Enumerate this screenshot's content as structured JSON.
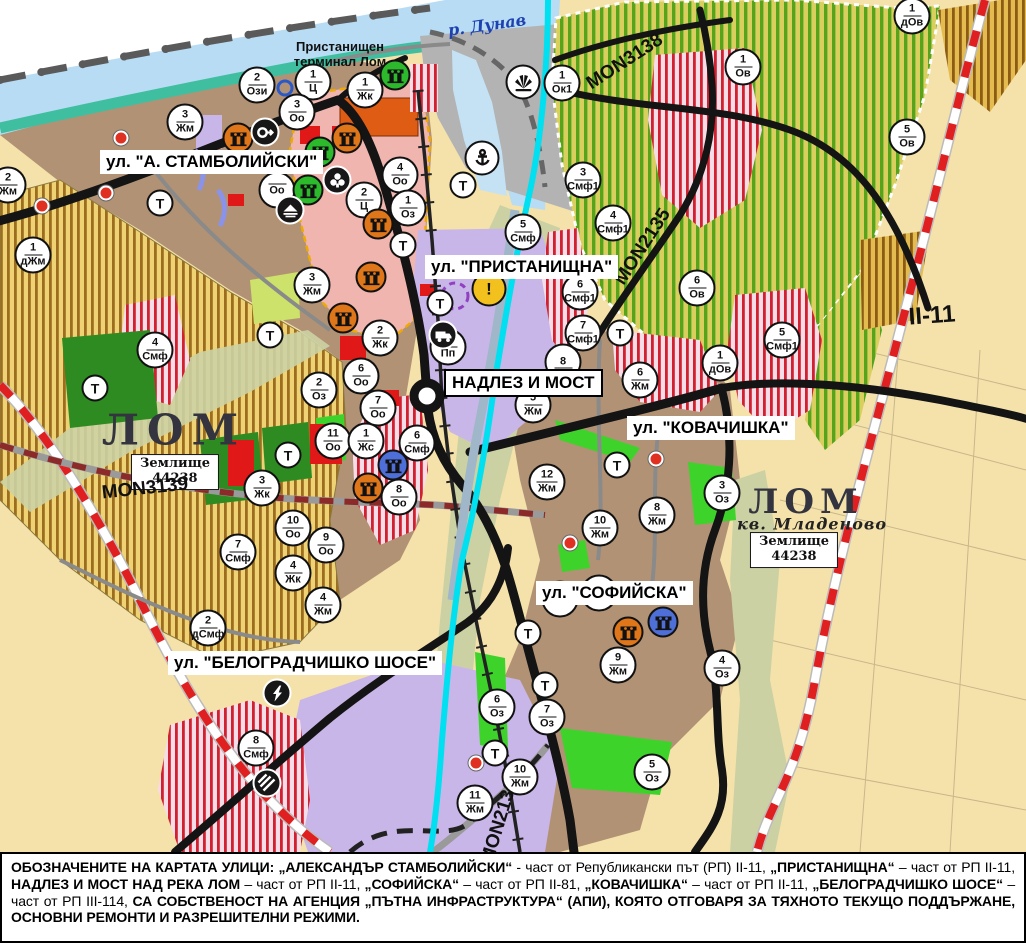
{
  "map": {
    "river_label": {
      "text": "р. Дунав",
      "x": 487,
      "y": 25,
      "fs": 16,
      "rot": -8
    },
    "terminal_label": {
      "line1": "Пристанищен",
      "line2": "терминал Лом",
      "x": 340,
      "y": 55,
      "fs": 13
    },
    "street_labels": [
      {
        "text": "ул. \"А. СТАМБОЛИЙСКИ\"",
        "x": 100,
        "y": 150,
        "fs": 17,
        "boxed": false
      },
      {
        "text": "ул. \"ПРИСТАНИЩНА\"",
        "x": 425,
        "y": 255,
        "fs": 17,
        "boxed": false
      },
      {
        "text": "НАДЛЕЗ И МОСТ",
        "x": 444,
        "y": 369,
        "fs": 17,
        "boxed": true
      },
      {
        "text": "ул. \"КОВАЧИШКА\"",
        "x": 627,
        "y": 416,
        "fs": 17,
        "boxed": false
      },
      {
        "text": "ул. \"СОФИЙСКА\"",
        "x": 536,
        "y": 581,
        "fs": 17,
        "boxed": false
      },
      {
        "text": "ул. \"БЕЛОГРАДЧИШКО ШОСЕ\"",
        "x": 168,
        "y": 651,
        "fs": 17,
        "boxed": false
      }
    ],
    "area_labels": [
      {
        "text": "ЛОМ",
        "x": 174,
        "y": 430,
        "fs": 42,
        "cls": "lom",
        "ls": 8
      },
      {
        "text": "ЛОМ",
        "x": 806,
        "y": 502,
        "fs": 34,
        "cls": "lom",
        "ls": 6
      },
      {
        "text": "кв. Младеново",
        "x": 812,
        "y": 524,
        "fs": 16,
        "cls": "mlad",
        "ls": 1
      }
    ],
    "zemlishte_boxes": [
      {
        "line1": "Землище",
        "line2": "44238",
        "x": 175,
        "y": 472
      },
      {
        "line1": "Землище",
        "line2": "44238",
        "x": 794,
        "y": 550
      }
    ],
    "road_labels": [
      {
        "text": "MON3139",
        "x": 145,
        "y": 489,
        "fs": 19,
        "rot": -6
      },
      {
        "text": "MON3138",
        "x": 625,
        "y": 62,
        "fs": 19,
        "rot": -33
      },
      {
        "text": "MON2135",
        "x": 643,
        "y": 247,
        "fs": 19,
        "rot": -57
      },
      {
        "text": "MON2136",
        "x": 500,
        "y": 822,
        "fs": 19,
        "rot": -73
      },
      {
        "text": "II-11",
        "x": 932,
        "y": 316,
        "fs": 24,
        "rot": -4
      }
    ],
    "t_label": "Т",
    "warn_label": "!",
    "zone_badges": [
      {
        "x": 257,
        "y": 85,
        "n": "2",
        "c": "Ози"
      },
      {
        "x": 313,
        "y": 82,
        "n": "1",
        "c": "Ц"
      },
      {
        "x": 365,
        "y": 90,
        "n": "1",
        "c": "Жк"
      },
      {
        "x": 297,
        "y": 112,
        "n": "3",
        "c": "Оо"
      },
      {
        "x": 185,
        "y": 122,
        "n": "3",
        "c": "Жм"
      },
      {
        "x": 8,
        "y": 185,
        "n": "2",
        "c": "Жм"
      },
      {
        "x": 33,
        "y": 255,
        "n": "1",
        "c": "дЖм"
      },
      {
        "x": 400,
        "y": 175,
        "n": "4",
        "c": "Оо"
      },
      {
        "x": 364,
        "y": 200,
        "n": "2",
        "c": "Ц"
      },
      {
        "x": 408,
        "y": 208,
        "n": "1",
        "c": "Оз"
      },
      {
        "x": 277,
        "y": 190,
        "n": "",
        "c": "Оо"
      },
      {
        "x": 562,
        "y": 83,
        "n": "1",
        "c": "Ок1"
      },
      {
        "x": 583,
        "y": 180,
        "n": "3",
        "c": "Смф1"
      },
      {
        "x": 613,
        "y": 223,
        "n": "4",
        "c": "Смф1"
      },
      {
        "x": 523,
        "y": 232,
        "n": "5",
        "c": "Смф"
      },
      {
        "x": 580,
        "y": 292,
        "n": "6",
        "c": "Смф1"
      },
      {
        "x": 583,
        "y": 333,
        "n": "7",
        "c": "Смф1"
      },
      {
        "x": 743,
        "y": 67,
        "n": "1",
        "c": "Ов"
      },
      {
        "x": 912,
        "y": 16,
        "n": "1",
        "c": "дОв"
      },
      {
        "x": 907,
        "y": 137,
        "n": "5",
        "c": "Ов"
      },
      {
        "x": 697,
        "y": 288,
        "n": "6",
        "c": "Ов"
      },
      {
        "x": 782,
        "y": 340,
        "n": "5",
        "c": "Смф1"
      },
      {
        "x": 720,
        "y": 363,
        "n": "1",
        "c": "дОв"
      },
      {
        "x": 312,
        "y": 285,
        "n": "3",
        "c": "Жм"
      },
      {
        "x": 380,
        "y": 338,
        "n": "2",
        "c": "Жк"
      },
      {
        "x": 361,
        "y": 376,
        "n": "6",
        "c": "Оо"
      },
      {
        "x": 319,
        "y": 390,
        "n": "2",
        "c": "Оз"
      },
      {
        "x": 378,
        "y": 408,
        "n": "7",
        "c": "Оо"
      },
      {
        "x": 333,
        "y": 441,
        "n": "11",
        "c": "Оо"
      },
      {
        "x": 366,
        "y": 441,
        "n": "1",
        "c": "Жс"
      },
      {
        "x": 417,
        "y": 443,
        "n": "6",
        "c": "Смф"
      },
      {
        "x": 399,
        "y": 497,
        "n": "8",
        "c": "Оо"
      },
      {
        "x": 262,
        "y": 488,
        "n": "3",
        "c": "Жк"
      },
      {
        "x": 155,
        "y": 350,
        "n": "4",
        "c": "Смф"
      },
      {
        "x": 238,
        "y": 552,
        "n": "7",
        "c": "Смф"
      },
      {
        "x": 293,
        "y": 528,
        "n": "10",
        "c": "Оо"
      },
      {
        "x": 326,
        "y": 545,
        "n": "9",
        "c": "Оо"
      },
      {
        "x": 293,
        "y": 573,
        "n": "4",
        "c": "Жк"
      },
      {
        "x": 323,
        "y": 605,
        "n": "4",
        "c": "Жм"
      },
      {
        "x": 208,
        "y": 628,
        "n": "2",
        "c": "дСмф"
      },
      {
        "x": 256,
        "y": 748,
        "n": "8",
        "c": "Смф"
      },
      {
        "x": 448,
        "y": 347,
        "n": "2",
        "c": "Пп"
      },
      {
        "x": 533,
        "y": 405,
        "n": "5",
        "c": "Жм"
      },
      {
        "x": 563,
        "y": 362,
        "n": "8",
        "c": ""
      },
      {
        "x": 640,
        "y": 380,
        "n": "6",
        "c": "Жм"
      },
      {
        "x": 547,
        "y": 482,
        "n": "12",
        "c": "Жм"
      },
      {
        "x": 600,
        "y": 528,
        "n": "10",
        "c": "Жм"
      },
      {
        "x": 657,
        "y": 515,
        "n": "8",
        "c": "Жм"
      },
      {
        "x": 722,
        "y": 493,
        "n": "3",
        "c": "Оз"
      },
      {
        "x": 560,
        "y": 599,
        "n": "",
        "c": "Оз"
      },
      {
        "x": 599,
        "y": 593,
        "n": "",
        "c": "Оз"
      },
      {
        "x": 618,
        "y": 665,
        "n": "9",
        "c": "Жм"
      },
      {
        "x": 722,
        "y": 668,
        "n": "4",
        "c": "Оз"
      },
      {
        "x": 652,
        "y": 772,
        "n": "5",
        "c": "Оз"
      },
      {
        "x": 497,
        "y": 707,
        "n": "6",
        "c": "Оз"
      },
      {
        "x": 547,
        "y": 717,
        "n": "7",
        "c": "Оз"
      },
      {
        "x": 520,
        "y": 777,
        "n": "10",
        "c": "Жм"
      },
      {
        "x": 475,
        "y": 803,
        "n": "11",
        "c": "Жм"
      }
    ],
    "t_badges": [
      {
        "x": 160,
        "y": 203
      },
      {
        "x": 463,
        "y": 185
      },
      {
        "x": 403,
        "y": 245
      },
      {
        "x": 440,
        "y": 303
      },
      {
        "x": 270,
        "y": 335
      },
      {
        "x": 95,
        "y": 388
      },
      {
        "x": 288,
        "y": 455
      },
      {
        "x": 620,
        "y": 333
      },
      {
        "x": 617,
        "y": 465
      },
      {
        "x": 528,
        "y": 633
      },
      {
        "x": 545,
        "y": 685
      },
      {
        "x": 495,
        "y": 753
      }
    ],
    "poi_icons": [
      {
        "x": 395,
        "y": 75,
        "type": "monument",
        "color": "green"
      },
      {
        "x": 238,
        "y": 138,
        "type": "monument",
        "color": "orange"
      },
      {
        "x": 347,
        "y": 138,
        "type": "monument",
        "color": "orange"
      },
      {
        "x": 320,
        "y": 152,
        "type": "monument",
        "color": "green"
      },
      {
        "x": 308,
        "y": 190,
        "type": "monument",
        "color": "green"
      },
      {
        "x": 378,
        "y": 224,
        "type": "monument",
        "color": "orange"
      },
      {
        "x": 371,
        "y": 277,
        "type": "monument",
        "color": "orange"
      },
      {
        "x": 343,
        "y": 318,
        "type": "monument",
        "color": "orange"
      },
      {
        "x": 368,
        "y": 488,
        "type": "monument",
        "color": "orange"
      },
      {
        "x": 628,
        "y": 632,
        "type": "monument",
        "color": "orange"
      },
      {
        "x": 393,
        "y": 465,
        "type": "monument",
        "color": "blue"
      },
      {
        "x": 663,
        "y": 622,
        "type": "monument",
        "color": "blue"
      },
      {
        "x": 265,
        "y": 132,
        "type": "circle-arrow",
        "color": "black"
      },
      {
        "x": 337,
        "y": 180,
        "type": "trefoil",
        "color": "black"
      },
      {
        "x": 290,
        "y": 210,
        "type": "mound",
        "color": "black"
      },
      {
        "x": 443,
        "y": 335,
        "type": "truck",
        "color": "black"
      },
      {
        "x": 277,
        "y": 693,
        "type": "lightning",
        "color": "black"
      },
      {
        "x": 267,
        "y": 783,
        "type": "rail-crossing",
        "color": "black"
      },
      {
        "x": 482,
        "y": 158,
        "type": "anchor",
        "color": "white"
      },
      {
        "x": 523,
        "y": 82,
        "type": "sun",
        "color": "white"
      },
      {
        "x": 489,
        "y": 289,
        "type": "warn",
        "color": "yellow"
      }
    ],
    "red_dots": [
      {
        "x": 121,
        "y": 138
      },
      {
        "x": 106,
        "y": 193
      },
      {
        "x": 42,
        "y": 206
      },
      {
        "x": 570,
        "y": 543
      },
      {
        "x": 656,
        "y": 459
      },
      {
        "x": 476,
        "y": 763
      }
    ],
    "blue_rings": [
      {
        "x": 285,
        "y": 88
      }
    ],
    "colors": {
      "orange": "#e0761a",
      "green": "#2cba2c",
      "blue": "#4f6fd8",
      "black": "#171717",
      "white": "#ffffff",
      "yellow": "#f2c11e",
      "water": "#b8dcf4",
      "canal": "#00e0f0",
      "boundary_red": "#e02020",
      "residential": "#b29275",
      "production": "#c9b6e9"
    }
  },
  "caption": {
    "segments": [
      {
        "t": "ОБОЗНАЧЕНИТЕ НА КАРТАТА УЛИЦИ: ",
        "b": true
      },
      {
        "t": "„АЛЕКСАНДЪР СТАМБОЛИЙСКИ“",
        "b": true
      },
      {
        "t": " - част от Републикански път (РП) II-11, ",
        "b": false
      },
      {
        "t": "„ПРИСТАНИЩНА“",
        "b": true
      },
      {
        "t": " – част от РП II-11, ",
        "b": false
      },
      {
        "t": "НАДЛЕЗ И МОСТ НАД РЕКА ЛОМ",
        "b": true
      },
      {
        "t": " – част от РП II-11, ",
        "b": false
      },
      {
        "t": "„СОФИЙСКА“",
        "b": true
      },
      {
        "t": " – част от РП II-81, ",
        "b": false
      },
      {
        "t": "„КОВАЧИШКА“",
        "b": true
      },
      {
        "t": " – част от РП II-11, ",
        "b": false
      },
      {
        "t": "„БЕЛОГРАДЧИШКО ШОСЕ“",
        "b": true
      },
      {
        "t": " – част от РП III-114, ",
        "b": false
      },
      {
        "t": "СА СОБСТВЕНОСТ НА АГЕНЦИЯ „ПЪТНА ИНФРАСТРУКТУРА“ (АПИ), КОЯТО ОТГОВАРЯ ЗА ТЯХНОТО ТЕКУЩО ПОДДЪРЖАНЕ, ОСНОВНИ РЕМОНТИ И РАЗРЕШИТЕЛНИ РЕЖИМИ.",
        "b": true
      }
    ]
  }
}
